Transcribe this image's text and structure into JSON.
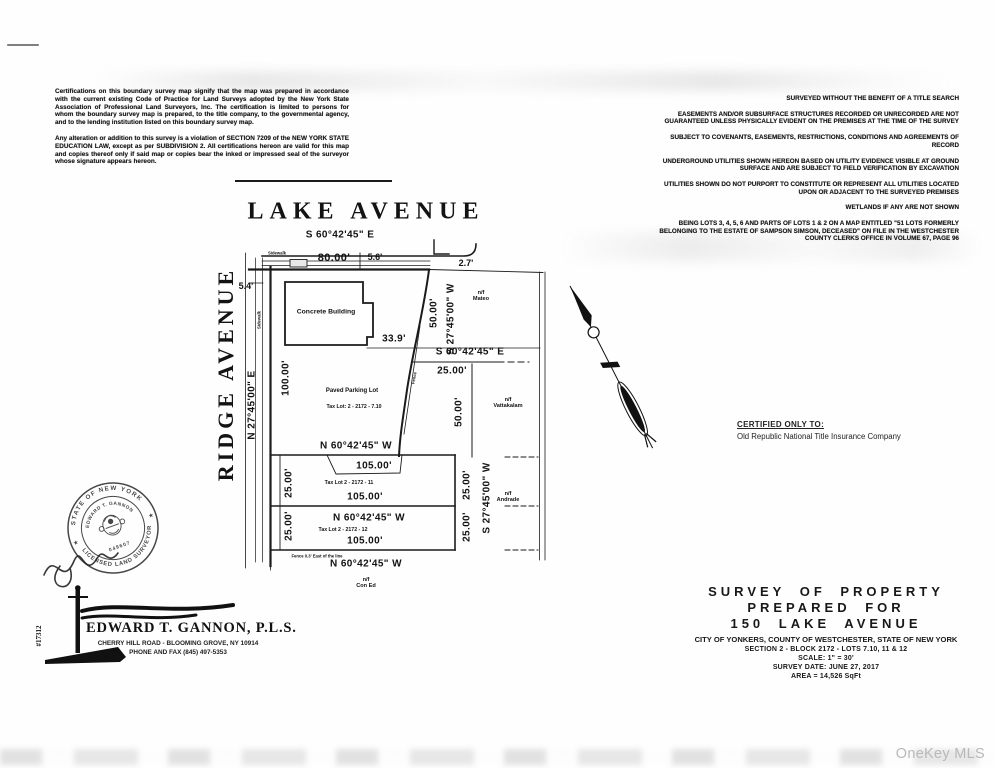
{
  "watermark": "OneKey MLS",
  "certification": {
    "para1": "Certifications on this boundary survey map signify that the map was prepared in accordance with the current existing Code of Practice for Land Surveys adopted by the New York State Association of Professional Land Surveyors, Inc. The certification is limited to persons for whom the boundary survey map is prepared, to the title company, to the governmental agency, and to the lending institution listed on this boundary survey map.",
    "para2": "Any alteration or addition to this survey is a violation of SECTION 7209 of the NEW YORK STATE EDUCATION LAW, except as per SUBDIVISION 2. All certifications hereon are valid for this map and copies thereof only if said map or copies bear the inked or impressed seal of the surveyor whose signature appears hereon."
  },
  "notes": [
    "SURVEYED WITHOUT THE BENEFIT OF A TITLE SEARCH",
    "EASEMENTS AND/OR SUBSURFACE STRUCTURES RECORDED OR UNRECORDED ARE NOT GUARANTEED UNLESS PHYSICALLY EVIDENT ON THE PREMISES AT THE TIME OF THE SURVEY",
    "SUBJECT TO COVENANTS, EASEMENTS, RESTRICTIONS, CONDITIONS AND AGREEMENTS OF RECORD",
    "UNDERGROUND UTILITIES SHOWN HEREON BASED ON UTILITY EVIDENCE VISIBLE AT GROUND SURFACE AND ARE SUBJECT TO FIELD VERIFICATION BY EXCAVATION",
    "UTILITIES SHOWN DO NOT PURPORT TO CONSTITUTE OR REPRESENT ALL UTILITIES LOCATED UPON OR ADJACENT TO THE SURVEYED PREMISES",
    "WETLANDS IF ANY ARE NOT SHOWN",
    "BEING LOTS 3, 4, 5, 6 AND PARTS OF LOTS 1 & 2 ON A MAP ENTITLED \"51 LOTS FORMERLY BELONGING TO THE ESTATE OF SAMPSON SIMSON, DECEASED\" ON FILE IN THE WESTCHESTER COUNTY CLERKS OFFICE IN VOLUME 67, PAGE 96"
  ],
  "map": {
    "lake_title": "LAKE AVENUE",
    "ridge_title": "RIDGE AVENUE",
    "bearing_top": "S 60°42'45\" E",
    "bearing_se_mid": "S 60°42'45\" E",
    "bearing_sw": "S 27°45'00\" W",
    "bearing_ne": "N 27°45'00\" E",
    "bearing_nw": "N 60°42'45\" W",
    "dim_80": "80.00'",
    "dim_5_6": "5.6'",
    "dim_2_7": "2.7'",
    "dim_5_4": "5.4'",
    "dim_100": "100.00'",
    "dim_50": "50.00'",
    "dim_33_9": "33.9'",
    "dim_25": "25.00'",
    "dim_105": "105.00'",
    "sidewalk": "Sidewalk",
    "building": "Concrete Building",
    "parking": "Paved Parking Lot",
    "taxlot_710": "Tax Lot: 2 - 2172 - 7.10",
    "taxlot_11": "Tax Lot 2 - 2172 - 11",
    "taxlot_12": "Tax Lot 2 - 2172 - 12",
    "fence": "Fence",
    "fence_note": "Fence 0.3' East of the line",
    "nf": {
      "mateo": [
        "n/f",
        "Mateo"
      ],
      "vattakalam": [
        "n/f",
        "Vattakalam"
      ],
      "andrade": [
        "n/f",
        "Andrade"
      ],
      "coned": [
        "n/f",
        "Con Ed"
      ]
    }
  },
  "certified_to": {
    "heading": "CERTIFIED ONLY TO:",
    "name": "Old Republic National Title Insurance Company"
  },
  "seal": {
    "outer_top": "STATE OF NEW YORK",
    "outer_bottom": "LICENSED LAND SURVEYOR",
    "inner": "EDWARD T. GANNON",
    "license_no": "049607",
    "star": "★"
  },
  "surveyor": {
    "job_no": "#17312",
    "name": "EDWARD T. GANNON, P.L.S.",
    "address": "CHERRY HILL ROAD - BLOOMING GROVE, NY 10914",
    "phone": "PHONE AND FAX (845) 497-5353"
  },
  "title_block": {
    "line1": "SURVEY OF PROPERTY",
    "line2": "PREPARED FOR",
    "line3": "150 LAKE AVENUE",
    "line4": "CITY OF YONKERS, COUNTY OF WESTCHESTER, STATE OF NEW YORK",
    "line5": "SECTION 2 - BLOCK 2172 - LOTS 7.10, 11 & 12",
    "line6": "SCALE: 1\" = 30'",
    "line7": "SURVEY DATE: JUNE 27, 2017",
    "line8": "AREA = 14,526 SqFt"
  }
}
